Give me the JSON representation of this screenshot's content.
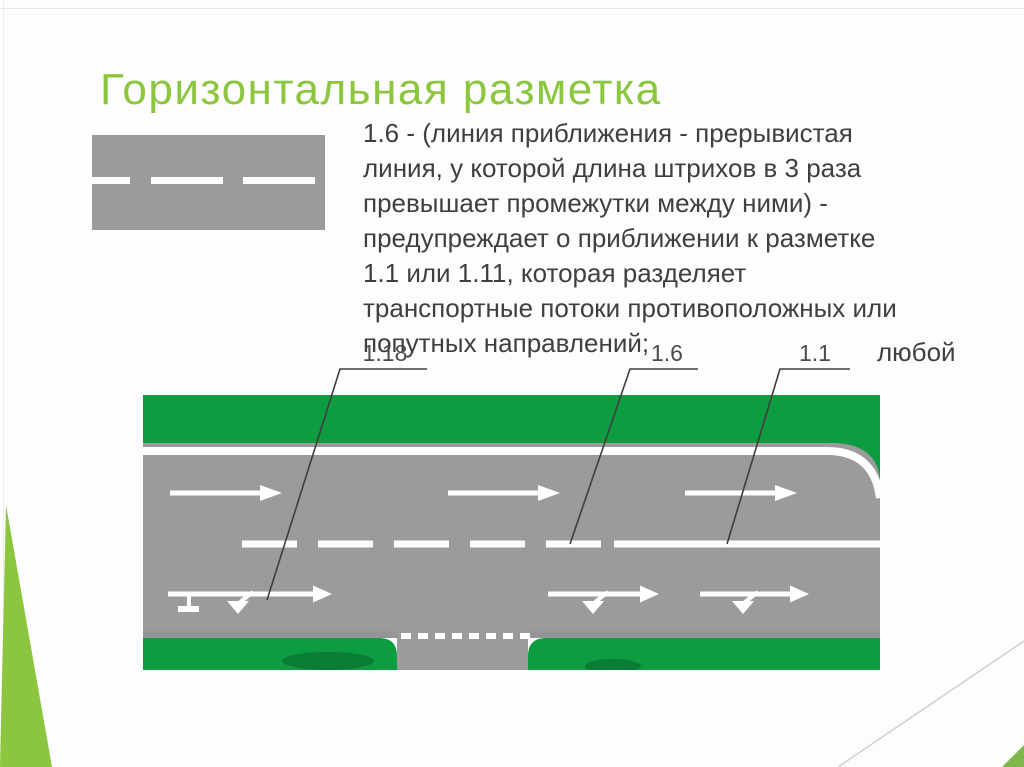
{
  "slide": {
    "title": "Горизонтальная разметка",
    "body_text": "1.6 - (линия приближения - прерывистая\nлиния, у которой длина штрихов в 3 раза\nпревышает промежутки между ними) -\nпредупреждает о приближении к разметке\n1.1 или 1.11, которая разделяет\nтранспортные потоки противоположных или\nпопутных направлений;",
    "overflow_text": "любой"
  },
  "diagram": {
    "labels": [
      {
        "text": "1.18"
      },
      {
        "text": "1.6"
      },
      {
        "text": "1.1"
      }
    ]
  },
  "colors": {
    "title_green": "#8CC63E",
    "body_text_gray": "#3F3F3F",
    "grass_green": "#0E9C40",
    "bush_green": "#0A7C33",
    "road_gray": "#9B9B9D",
    "marking_white": "#FFFFFF",
    "callout_line": "#3E3E3E",
    "label_text": "#4B4B4B",
    "corner_wedge_green": "#8CC63E",
    "corner_triangle_green": "#7DB848",
    "divider_line_gray": "#D0D0D0"
  }
}
